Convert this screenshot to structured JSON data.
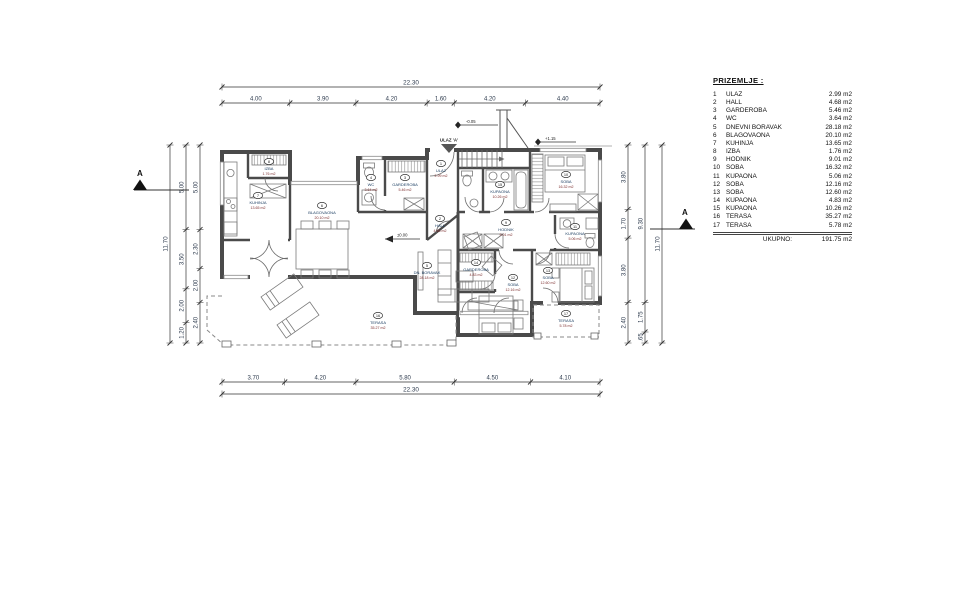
{
  "legend": {
    "title": "PRIZEMLJE :",
    "rows": [
      {
        "num": "1",
        "name": "ULAZ",
        "area": "2.99 m2"
      },
      {
        "num": "2",
        "name": "HALL",
        "area": "4.68 m2"
      },
      {
        "num": "3",
        "name": "GARDEROBA",
        "area": "5.46 m2"
      },
      {
        "num": "4",
        "name": "WC",
        "area": "3.64 m2"
      },
      {
        "num": "5",
        "name": "DNEVNI BORAVAK",
        "area": "28.18 m2"
      },
      {
        "num": "6",
        "name": "BLAGOVAONA",
        "area": "20.10 m2"
      },
      {
        "num": "7",
        "name": "KUHINJA",
        "area": "13.65 m2"
      },
      {
        "num": "8",
        "name": "IZBA",
        "area": "1.76 m2"
      },
      {
        "num": "9",
        "name": "HODNIK",
        "area": "9.01 m2"
      },
      {
        "num": "10",
        "name": "SOBA",
        "area": "16.32 m2"
      },
      {
        "num": "11",
        "name": "KUPAONA",
        "area": "5.06 m2"
      },
      {
        "num": "12",
        "name": "SOBA",
        "area": "12.16 m2"
      },
      {
        "num": "13",
        "name": "SOBA",
        "area": "12.60 m2"
      },
      {
        "num": "14",
        "name": "KUPAONA",
        "area": "4.83 m2"
      },
      {
        "num": "15",
        "name": "KUPAONA",
        "area": "10.26 m2"
      },
      {
        "num": "16",
        "name": "TERASA",
        "area": "35.27 m2"
      },
      {
        "num": "17",
        "name": "TERASA",
        "area": "5.78 m2"
      }
    ],
    "total_label": "UKUPNO:",
    "total_value": "191.75 m2"
  },
  "plan": {
    "rooms": [
      {
        "num": "1",
        "name": "ULAZ",
        "area": "2.99 m2",
        "x": 441,
        "y": 170
      },
      {
        "num": "2",
        "name": "HALL",
        "area": "4.68 m2",
        "x": 440,
        "y": 225
      },
      {
        "num": "3",
        "name": "GARDEROBA",
        "area": "5.46 m2",
        "x": 405,
        "y": 184
      },
      {
        "num": "4",
        "name": "WC",
        "area": "3.64 m2",
        "x": 371,
        "y": 184
      },
      {
        "num": "5",
        "name": "DN. BORAVAK",
        "area": "28.18 m2",
        "x": 427,
        "y": 272
      },
      {
        "num": "6",
        "name": "BLAGOVAONA",
        "area": "20.10 m2",
        "x": 322,
        "y": 212
      },
      {
        "num": "7",
        "name": "KUHINJA",
        "area": "13.65 m2",
        "x": 258,
        "y": 202
      },
      {
        "num": "8",
        "name": "IZBA",
        "area": "1.76 m2",
        "x": 269,
        "y": 168
      },
      {
        "num": "9",
        "name": "HODNIK",
        "area": "9.01 m2",
        "x": 506,
        "y": 229
      },
      {
        "num": "10",
        "name": "SOBA",
        "area": "16.32 m2",
        "x": 566,
        "y": 181
      },
      {
        "num": "11",
        "name": "KUPAONA",
        "area": "5.06 m2",
        "x": 575,
        "y": 233
      },
      {
        "num": "12",
        "name": "SOBA",
        "area": "12.16 m2",
        "x": 513,
        "y": 284
      },
      {
        "num": "13",
        "name": "SOBA",
        "area": "12.60 m2",
        "x": 548,
        "y": 277
      },
      {
        "num": "14",
        "name": "GARDEROBA",
        "area": "4.83 m2",
        "x": 476,
        "y": 269
      },
      {
        "num": "15",
        "name": "KUPAONA",
        "area": "10.26 m2",
        "x": 500,
        "y": 191
      },
      {
        "num": "16",
        "name": "TERASA",
        "area": "35.27 m2",
        "x": 378,
        "y": 322
      },
      {
        "num": "17",
        "name": "TERASA",
        "area": "5.78 m2",
        "x": 566,
        "y": 320
      }
    ],
    "markers": {
      "entrance": "ULAZ 'A'",
      "elev_entrance": "-0.05",
      "elev_upper": "+1.15",
      "elev_floor": "±0.00",
      "section": "A"
    },
    "dims": {
      "top_total": [
        "22.30"
      ],
      "top_segments": [
        "4.00",
        "3.90",
        "4.20",
        "1.60",
        "4.20",
        "4.40"
      ],
      "bottom_segments": [
        "3.70",
        "4.20",
        "5.80",
        "4.50",
        "4.10"
      ],
      "bottom_total": [
        "22.30"
      ],
      "left_total": [
        "11.70"
      ],
      "left_outer": [
        "5.00",
        "3.50",
        "2.00",
        "1.20"
      ],
      "left_inner": [
        "5.00",
        "2.30",
        "2.00",
        "2.40"
      ],
      "right_inner": [
        "3.80",
        "1.70",
        "3.80",
        "2.40"
      ],
      "right_mid": [
        "9.30",
        "1.75",
        ".65"
      ],
      "right_total": [
        "11.70"
      ]
    }
  },
  "colors": {
    "walls": "#4a4a4a",
    "room_name": "#173a5e",
    "room_area": "#7c2d2d",
    "dims": "#2e3b4e"
  }
}
